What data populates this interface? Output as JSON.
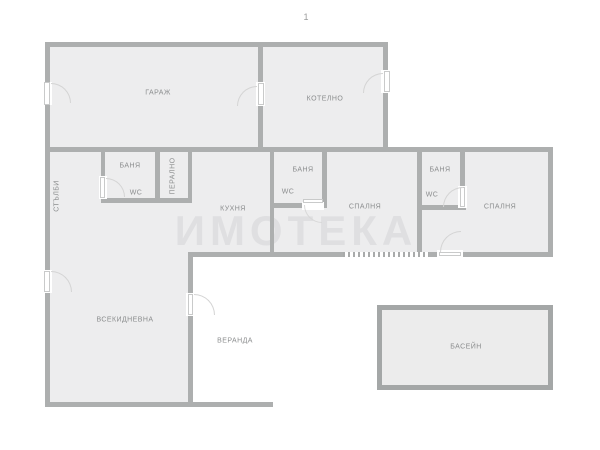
{
  "plan": {
    "number": "1",
    "watermark": "ИМОТЕКА"
  },
  "rooms": [
    {
      "id": "garage",
      "label": "ГАРАЖ"
    },
    {
      "id": "boiler",
      "label": "КОТЕЛНО"
    },
    {
      "id": "stairs",
      "label": "СТЪЛБИ"
    },
    {
      "id": "bath1",
      "label": "БАНЯ"
    },
    {
      "id": "wc1",
      "label": "WC"
    },
    {
      "id": "laundry",
      "label": "ПЕРАЛНО"
    },
    {
      "id": "kitchen",
      "label": "КУХНЯ"
    },
    {
      "id": "bath2",
      "label": "БАНЯ"
    },
    {
      "id": "wc2",
      "label": "WC"
    },
    {
      "id": "bedroom1",
      "label": "СПАЛНЯ"
    },
    {
      "id": "bath3",
      "label": "БАНЯ"
    },
    {
      "id": "wc3",
      "label": "WC"
    },
    {
      "id": "bedroom2",
      "label": "СПАЛНЯ"
    },
    {
      "id": "living",
      "label": "ВСЕКИДНЕВНА"
    },
    {
      "id": "veranda",
      "label": "ВЕРАНДА"
    },
    {
      "id": "pool",
      "label": "БАСЕЙН"
    }
  ],
  "colors": {
    "wall": "#adafaf",
    "room_fill": "#ededee",
    "outside": "#ffffff",
    "label_text": "#8b8d8e",
    "pool_fill": "#ececec",
    "pool_border": "#a4a7a7",
    "watermark": "rgba(125,125,135,0.12)"
  }
}
